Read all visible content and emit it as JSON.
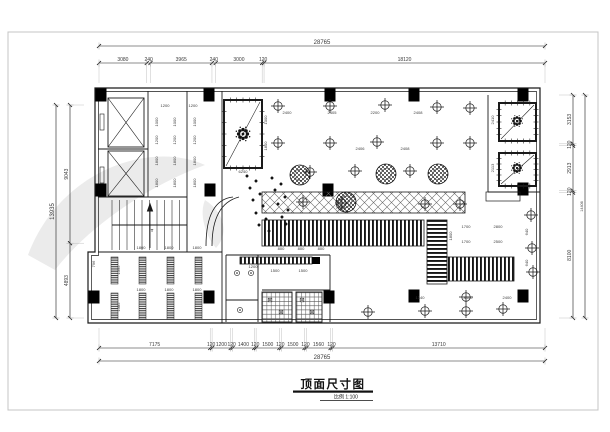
{
  "sheet": {
    "background": "#ffffff",
    "frame_color": "#c4c4c4",
    "ink_color": "#1a1a1a",
    "dim_text_color": "#3a3a3a",
    "ext_line_color": "#a8a8a8",
    "watermark_color": "#ebebeb"
  },
  "title_block": {
    "title": "顶面尺寸图",
    "scale_label": "比例 1:100"
  },
  "dimensions": {
    "top": {
      "total": "28765",
      "segments": [
        "3080",
        "240",
        "3965",
        "240",
        "3000",
        "120",
        "18120"
      ]
    },
    "bottom": {
      "total": "28765",
      "segments": [
        "7175",
        "120",
        "1200",
        "120",
        "1400",
        "120",
        "1500",
        "120",
        "1500",
        "120",
        "1560",
        "120",
        "13710"
      ]
    },
    "left": {
      "total": "13935",
      "segments": [
        "9043",
        "4893"
      ]
    },
    "right": {
      "total": "14406",
      "segments": [
        "3153",
        "120",
        "2913",
        "120",
        "8100"
      ]
    }
  },
  "geometry": {
    "walls_outer": "M95,88 H540 V323 H88 V252 H95 Z",
    "walls_inner": "M98.5,91.5 H536.5 V319.5 H91.5 V255.5 H98.5 Z",
    "wall_segments": [
      [
        148,
        91,
        148,
        197
      ],
      [
        98,
        149,
        148,
        149
      ],
      [
        98,
        197,
        187,
        197
      ],
      [
        187,
        91,
        187,
        252
      ],
      [
        98,
        252,
        222,
        252
      ],
      [
        222,
        91,
        222,
        323
      ],
      [
        226,
        255,
        330,
        255
      ],
      [
        226,
        255,
        226,
        322
      ],
      [
        258,
        255,
        258,
        322
      ],
      [
        226,
        300,
        258,
        300
      ],
      [
        330,
        255,
        330,
        322
      ],
      [
        262,
        290,
        330,
        290
      ],
      [
        292,
        292,
        292,
        322
      ],
      [
        488,
        95,
        488,
        192
      ],
      [
        488,
        192,
        540,
        192
      ]
    ],
    "arcs": [
      "M233,197 Q206,200 206,246",
      "M239,197 Q212,204 212,246"
    ],
    "columns": [
      [
        101,
        95
      ],
      [
        209,
        95
      ],
      [
        330,
        95
      ],
      [
        414,
        95
      ],
      [
        523,
        95
      ],
      [
        101,
        190
      ],
      [
        210,
        190
      ],
      [
        328,
        190
      ],
      [
        523,
        189
      ],
      [
        94,
        297
      ],
      [
        209,
        297
      ],
      [
        329,
        297
      ],
      [
        414,
        296
      ],
      [
        523,
        296
      ]
    ],
    "column_size": [
      11,
      13
    ],
    "elevators": [
      [
        108,
        98,
        36,
        49
      ],
      [
        108,
        151,
        36,
        45
      ]
    ],
    "elevator_doors": [
      [
        100,
        114,
        4,
        16
      ],
      [
        100,
        167,
        4,
        16
      ]
    ],
    "stairs": {
      "x": 112,
      "y": 200,
      "w": 75,
      "h": 50,
      "steps": 10
    },
    "thick_rooms": [
      [
        224,
        100,
        38,
        68
      ],
      [
        499,
        103,
        37,
        38
      ],
      [
        499,
        153,
        37,
        33
      ]
    ],
    "diagonals": [
      [
        226,
        166,
        260,
        102
      ],
      [
        501,
        139,
        534,
        105
      ],
      [
        501,
        184,
        534,
        155
      ]
    ],
    "medallions": [
      [
        243,
        134,
        1.0
      ],
      [
        517,
        121,
        0.8
      ],
      [
        517,
        168,
        0.8
      ]
    ],
    "bands": [
      {
        "t": "d",
        "r": [
          262,
          192,
          203,
          21
        ]
      },
      {
        "t": "v",
        "r": [
          262,
          220,
          162,
          26
        ]
      },
      {
        "t": "h",
        "r": [
          427,
          220,
          20,
          64
        ]
      },
      {
        "t": "v",
        "r": [
          447,
          257,
          67,
          24
        ]
      },
      {
        "t": "v",
        "r": [
          240,
          257,
          72,
          7
        ]
      }
    ],
    "black_boxes": [
      [
        312,
        257,
        8,
        7
      ]
    ],
    "shelf": [
      486,
      192,
      34,
      9
    ],
    "grid_rooms": [
      [
        262,
        292,
        30,
        30
      ],
      [
        296,
        292,
        26,
        30
      ]
    ],
    "bars": {
      "xs": [
        111,
        139,
        167,
        195
      ],
      "w": 7,
      "rows": [
        [
          257,
          27
        ],
        [
          293,
          26
        ]
      ]
    },
    "lights": [
      [
        278,
        106
      ],
      [
        330,
        106
      ],
      [
        385,
        105
      ],
      [
        437,
        107
      ],
      [
        470,
        108
      ],
      [
        278,
        143
      ],
      [
        330,
        143
      ],
      [
        377,
        142
      ],
      [
        437,
        143
      ],
      [
        470,
        143
      ],
      [
        310,
        172
      ],
      [
        355,
        171
      ],
      [
        410,
        171
      ],
      [
        303,
        202
      ],
      [
        342,
        203
      ],
      [
        425,
        204
      ],
      [
        460,
        204
      ],
      [
        531,
        215
      ],
      [
        532,
        248
      ],
      [
        533,
        272
      ],
      [
        466,
        297
      ],
      [
        368,
        312
      ],
      [
        425,
        311
      ],
      [
        466,
        311
      ],
      [
        503,
        309
      ]
    ],
    "fans": [
      [
        300,
        175
      ],
      [
        386,
        174
      ],
      [
        438,
        174
      ],
      [
        346,
        202
      ]
    ],
    "spotlights": [
      [
        247,
        176
      ],
      [
        256,
        181
      ],
      [
        250,
        188
      ],
      [
        260,
        194
      ],
      [
        253,
        200
      ],
      [
        263,
        206
      ],
      [
        256,
        213
      ],
      [
        266,
        219
      ],
      [
        259,
        225
      ],
      [
        269,
        231
      ],
      [
        272,
        178
      ],
      [
        281,
        184
      ],
      [
        275,
        190
      ],
      [
        285,
        197
      ],
      [
        278,
        204
      ],
      [
        288,
        210
      ],
      [
        282,
        217
      ],
      [
        286,
        224
      ]
    ],
    "lamp_circles": [
      [
        237,
        273
      ],
      [
        251,
        273
      ],
      [
        240,
        310
      ]
    ],
    "lamp_squares": [
      [
        270,
        300
      ],
      [
        281,
        312
      ],
      [
        302,
        300
      ],
      [
        312,
        312
      ]
    ]
  },
  "interior_labels": [
    [
      165,
      107,
      "1200",
      0
    ],
    [
      193,
      107,
      "1200",
      0
    ],
    [
      158,
      122,
      "1000",
      -90
    ],
    [
      158,
      140,
      "1200",
      -90
    ],
    [
      158,
      161,
      "1800",
      -90
    ],
    [
      158,
      183,
      "1800",
      -90
    ],
    [
      176,
      122,
      "1000",
      -90
    ],
    [
      176,
      140,
      "1200",
      -90
    ],
    [
      176,
      161,
      "1800",
      -90
    ],
    [
      176,
      183,
      "1800",
      -90
    ],
    [
      196,
      122,
      "1000",
      -90
    ],
    [
      196,
      140,
      "1200",
      -90
    ],
    [
      196,
      161,
      "1800",
      -90
    ],
    [
      196,
      183,
      "1800",
      -90
    ],
    [
      287,
      114,
      "2400",
      0
    ],
    [
      332,
      114,
      "2405",
      0
    ],
    [
      375,
      114,
      "2200",
      0
    ],
    [
      418,
      114,
      "2408",
      0
    ],
    [
      360,
      150,
      "2406",
      0
    ],
    [
      405,
      150,
      "2408",
      0
    ],
    [
      267,
      120,
      "1000",
      -90
    ],
    [
      267,
      146,
      "1800",
      -90
    ],
    [
      243,
      173,
      "6240",
      0
    ],
    [
      340,
      209,
      "7340",
      0
    ],
    [
      281,
      250,
      "800",
      0
    ],
    [
      301,
      250,
      "800",
      0
    ],
    [
      321,
      250,
      "800",
      0
    ],
    [
      141,
      249,
      "1800",
      0
    ],
    [
      169,
      249,
      "1800",
      0
    ],
    [
      197,
      249,
      "1800",
      0
    ],
    [
      141,
      291,
      "1800",
      0
    ],
    [
      169,
      291,
      "1800",
      0
    ],
    [
      197,
      291,
      "1800",
      0
    ],
    [
      120,
      270,
      "1395",
      -90
    ],
    [
      120,
      307,
      "1385",
      -90
    ],
    [
      95,
      264,
      "796",
      -90
    ],
    [
      253,
      268,
      "1200",
      0
    ],
    [
      275,
      272,
      "1500",
      0
    ],
    [
      303,
      272,
      "1500",
      0
    ],
    [
      466,
      228,
      "1700",
      0
    ],
    [
      498,
      228,
      "2800",
      0
    ],
    [
      466,
      243,
      "1700",
      0
    ],
    [
      498,
      243,
      "2500",
      0
    ],
    [
      452,
      236,
      "1800",
      -90
    ],
    [
      420,
      299,
      "1340",
      0
    ],
    [
      468,
      299,
      "8400",
      0
    ],
    [
      507,
      299,
      "2400",
      0
    ],
    [
      494,
      120,
      "2410",
      -90
    ],
    [
      494,
      168,
      "2113",
      -90
    ],
    [
      528,
      232,
      "640",
      -90
    ],
    [
      528,
      263,
      "640",
      -90
    ],
    [
      152,
      232,
      "T",
      0
    ]
  ]
}
